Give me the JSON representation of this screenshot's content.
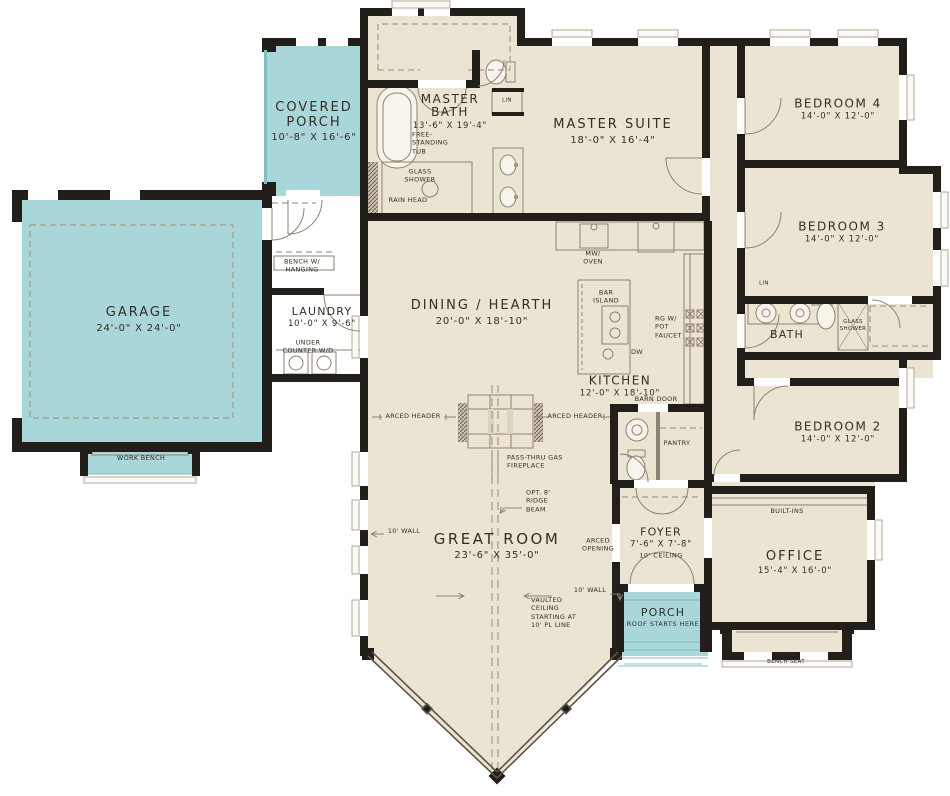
{
  "title": "House floor plan",
  "colors": {
    "floor_beige": "#ece4d2",
    "porch_teal": "#a9d6d9",
    "wall_black": "#221e1a",
    "thin_line": "#8b8271",
    "text": "#332e26"
  },
  "rooms": {
    "covered_porch": {
      "name": "COVERED PORCH",
      "dims": "10'-8\" X 16'-6\""
    },
    "master_bath": {
      "name": "MASTER BATH",
      "dims": "13'-6\" X 19'-4\""
    },
    "master_suite": {
      "name": "MASTER SUITE",
      "dims": "18'-0\" X 16'-4\""
    },
    "bedroom4": {
      "name": "BEDROOM 4",
      "dims": "14'-0\" X 12'-0\""
    },
    "bedroom3": {
      "name": "BEDROOM 3",
      "dims": "14'-0\" X 12'-0\""
    },
    "bath": {
      "name": "BATH"
    },
    "bedroom2": {
      "name": "BEDROOM 2",
      "dims": "14'-0\" X 12'-0\""
    },
    "garage": {
      "name": "GARAGE",
      "dims": "24'-0\" X 24'-0\""
    },
    "laundry": {
      "name": "LAUNDRY",
      "dims": "10'-0\" X 9'-6\""
    },
    "dining_hearth": {
      "name": "DINING / HEARTH",
      "dims": "20'-0\" X 18'-10\""
    },
    "kitchen": {
      "name": "KITCHEN",
      "dims": "12'-0\" X 18'-10\""
    },
    "great_room": {
      "name": "GREAT ROOM",
      "dims": "23'-6\" X 35'-0\""
    },
    "foyer": {
      "name": "FOYER",
      "dims": "7'-6\" X 7'-8\"",
      "note": "10' CEILING"
    },
    "office": {
      "name": "OFFICE",
      "dims": "15'-4\" X 16'-0\""
    },
    "porch": {
      "name": "PORCH",
      "note": "ROOF STARTS HERE"
    }
  },
  "ann": {
    "free_standing_tub": "FREE- STANDING TUB",
    "glass_shower": "GLASS SHOWER",
    "rain_head": "RAIN HEAD",
    "lin": "LIN",
    "bench_w_hanging": "BENCH W/ HANGING",
    "under_counter_wd": "UNDER COUNTER W/D",
    "work_bench": "WORK BENCH",
    "mw_oven": "MW/ OVEN",
    "bar_island": "BAR ISLAND",
    "rg_w_pot_faucet": "RG W/ POT FAUCET",
    "dw": "DW",
    "barn_door": "BARN DOOR",
    "pantry": "PANTRY",
    "arced_header": "ARCED HEADER",
    "pass_thru_fireplace": "PASS-THRU GAS FIREPLACE",
    "opt_ridge_beam": "OPT. 8' RIDGE BEAM",
    "wall_10": "10' WALL",
    "vaulted_ceiling": "VAULTED CEILING STARTING AT 10' PL LINE",
    "arced_opening": "ARCED OPENING",
    "built_ins": "BUILT-INS",
    "raised_bench_seat": "RAISED BENCH SEAT"
  }
}
